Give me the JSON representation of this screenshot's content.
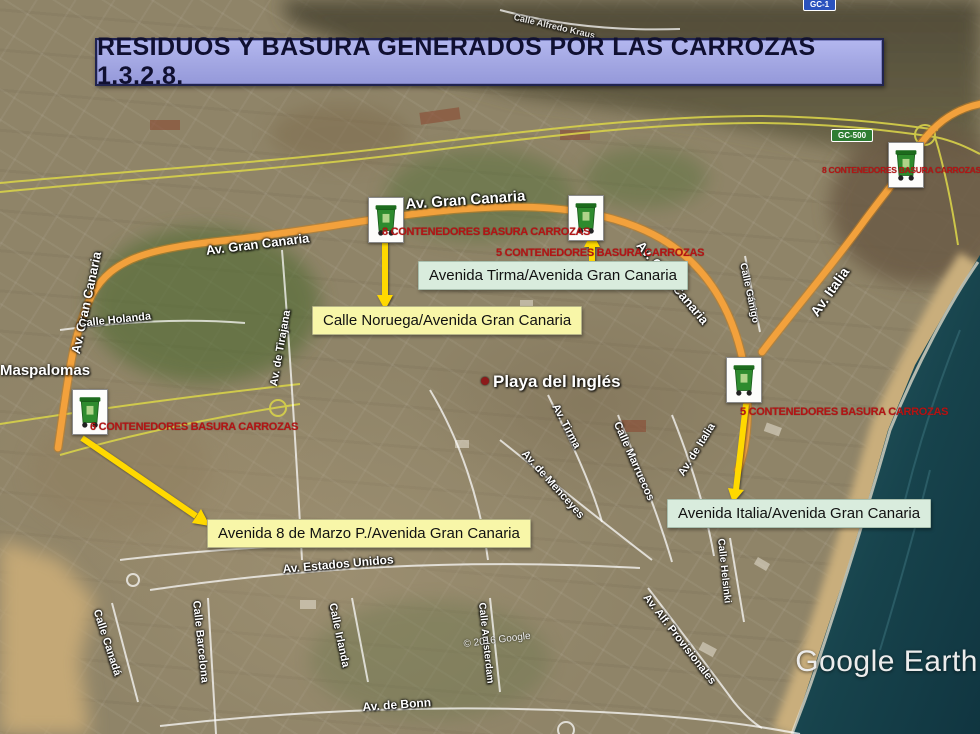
{
  "title": {
    "text": "RESIDUOS Y BASURA GENERADOS POR LAS CARROZAS 1.3.2.8."
  },
  "containers": {
    "noruega": {
      "count_label": "8 CONTENEDORES BASURA CARROZAS",
      "callout": "Calle Noruega/Avenida Gran Canaria"
    },
    "tirma": {
      "count_label": "5 CONTENEDORES BASURA CARROZAS",
      "callout": "Avenida Tirma/Avenida Gran Canaria"
    },
    "gc500": {
      "count_label": "8 CONTENEDORES BASURA CARROZAS"
    },
    "italia": {
      "count_label": "5 CONTENEDORES BASURA CARROZAS",
      "callout": "Avenida Italia/Avenida Gran Canaria"
    },
    "marzo": {
      "count_label": "6 CONTENEDORES BASURA CARROZAS",
      "callout": "Avenida 8 de Marzo P./Avenida Gran Canaria"
    }
  },
  "streets": [
    "Calle Alfredo Kraus",
    "Av. Gran Canaria",
    "Av. Gran Canaria",
    "Av. Gran Canaria",
    "Av. Gran Canaria",
    "Av. Italia",
    "Calle Gánigo",
    "Calle Holanda",
    "Av. de Tirajana",
    "Av. Tirma",
    "Calle Marruecos",
    "Av. de Menceyes",
    "Av. de Italia",
    "Calle Helsinki",
    "Av. Alf. Provisionales",
    "Av. Estados Unidos",
    "Calle Canadá",
    "Calle Barcelona",
    "Calle Irlanda",
    "Av. de Bonn",
    "Calle Amsterdam"
  ],
  "places": {
    "maspalomas": "Maspalomas",
    "playa": "Playa del Inglés"
  },
  "signs": {
    "gc1": "GC-1",
    "gc500": "GC-500"
  },
  "watermark": {
    "copyright": "© 2016 Google",
    "logo": "Google Earth"
  },
  "colors": {
    "route_orange": "#f2a13c",
    "arrow_yellow": "#ffd900",
    "callout_yellow": "#f8f6a8",
    "callout_green": "#d9ecdd",
    "banner_bg": "#a2a6e2",
    "red_label": "#b31414"
  }
}
